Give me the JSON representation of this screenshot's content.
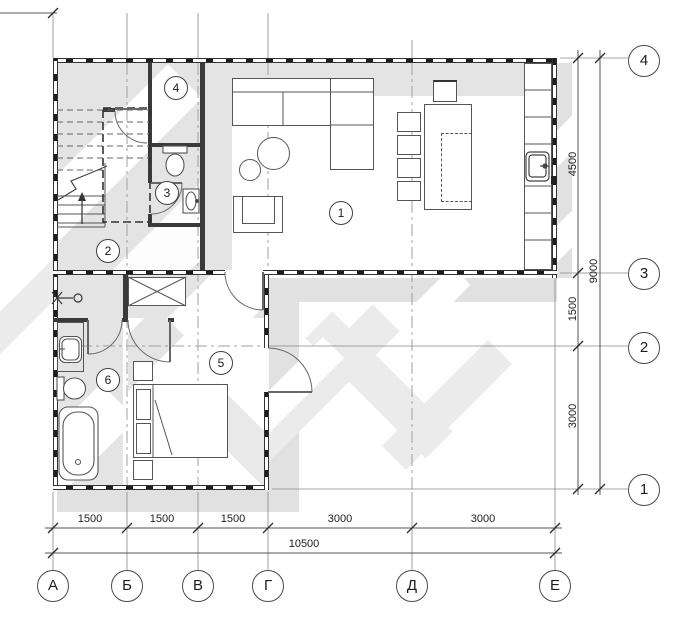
{
  "drawing": {
    "type": "floor-plan",
    "rooms": [
      {
        "number": "1"
      },
      {
        "number": "2"
      },
      {
        "number": "3"
      },
      {
        "number": "4"
      },
      {
        "number": "5"
      },
      {
        "number": "6"
      }
    ],
    "axes": {
      "horizontal": [
        "А",
        "Б",
        "В",
        "Г",
        "Д",
        "Е"
      ],
      "vertical": [
        "4",
        "3",
        "2",
        "1"
      ]
    },
    "dimensions": {
      "bottom_segments": [
        "1500",
        "1500",
        "1500",
        "3000",
        "3000"
      ],
      "bottom_total": "10500",
      "right_segments": [
        "4500",
        "1500",
        "3000"
      ],
      "right_total": "9000"
    },
    "colors": {
      "floor": "#e4e4e4",
      "shadow": "#e1e1e1",
      "wall": "#3a3a3a",
      "line": "#555555"
    }
  }
}
